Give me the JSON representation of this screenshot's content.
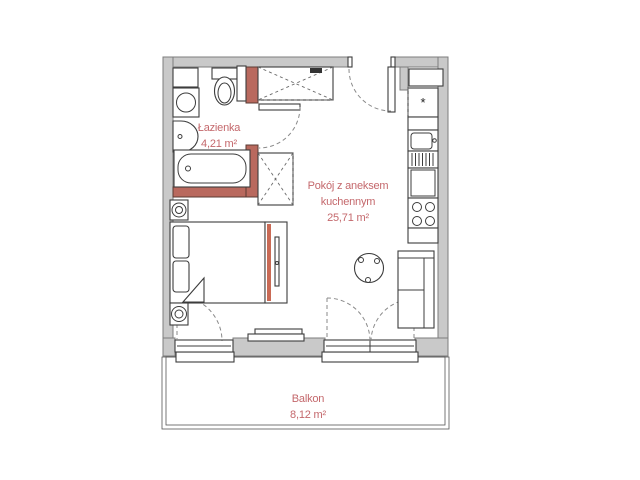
{
  "colors": {
    "wall_gray": "#c9c9c9",
    "wall_red": "#b9695e",
    "label": "#c4686c",
    "bed_accent": "#c96a55"
  },
  "rooms": {
    "bathroom": {
      "name": "Łazienka",
      "area": "4,21 m²"
    },
    "living": {
      "name_line1": "Pokój z aneksem",
      "name_line2": "kuchennym",
      "area": "25,71 m²"
    },
    "balcony": {
      "name": "Balkon",
      "area": "8,12 m²"
    }
  },
  "symbols": {
    "fridge_star": "*"
  },
  "fixtures": [
    "washing-machine",
    "bathroom-cabinet",
    "toilet",
    "washbasin",
    "bathtub",
    "wardrobe",
    "shower-cabin",
    "entrance-door",
    "bathroom-door",
    "fridge",
    "kitchen-sink",
    "dish-drainer",
    "kitchen-counter",
    "stove",
    "niche-shelf",
    "bed",
    "pillows",
    "tv-unit",
    "bedside-plant",
    "radiator",
    "round-table",
    "sofa",
    "balcony-door",
    "balcony-double-door",
    "balcony-railing"
  ]
}
